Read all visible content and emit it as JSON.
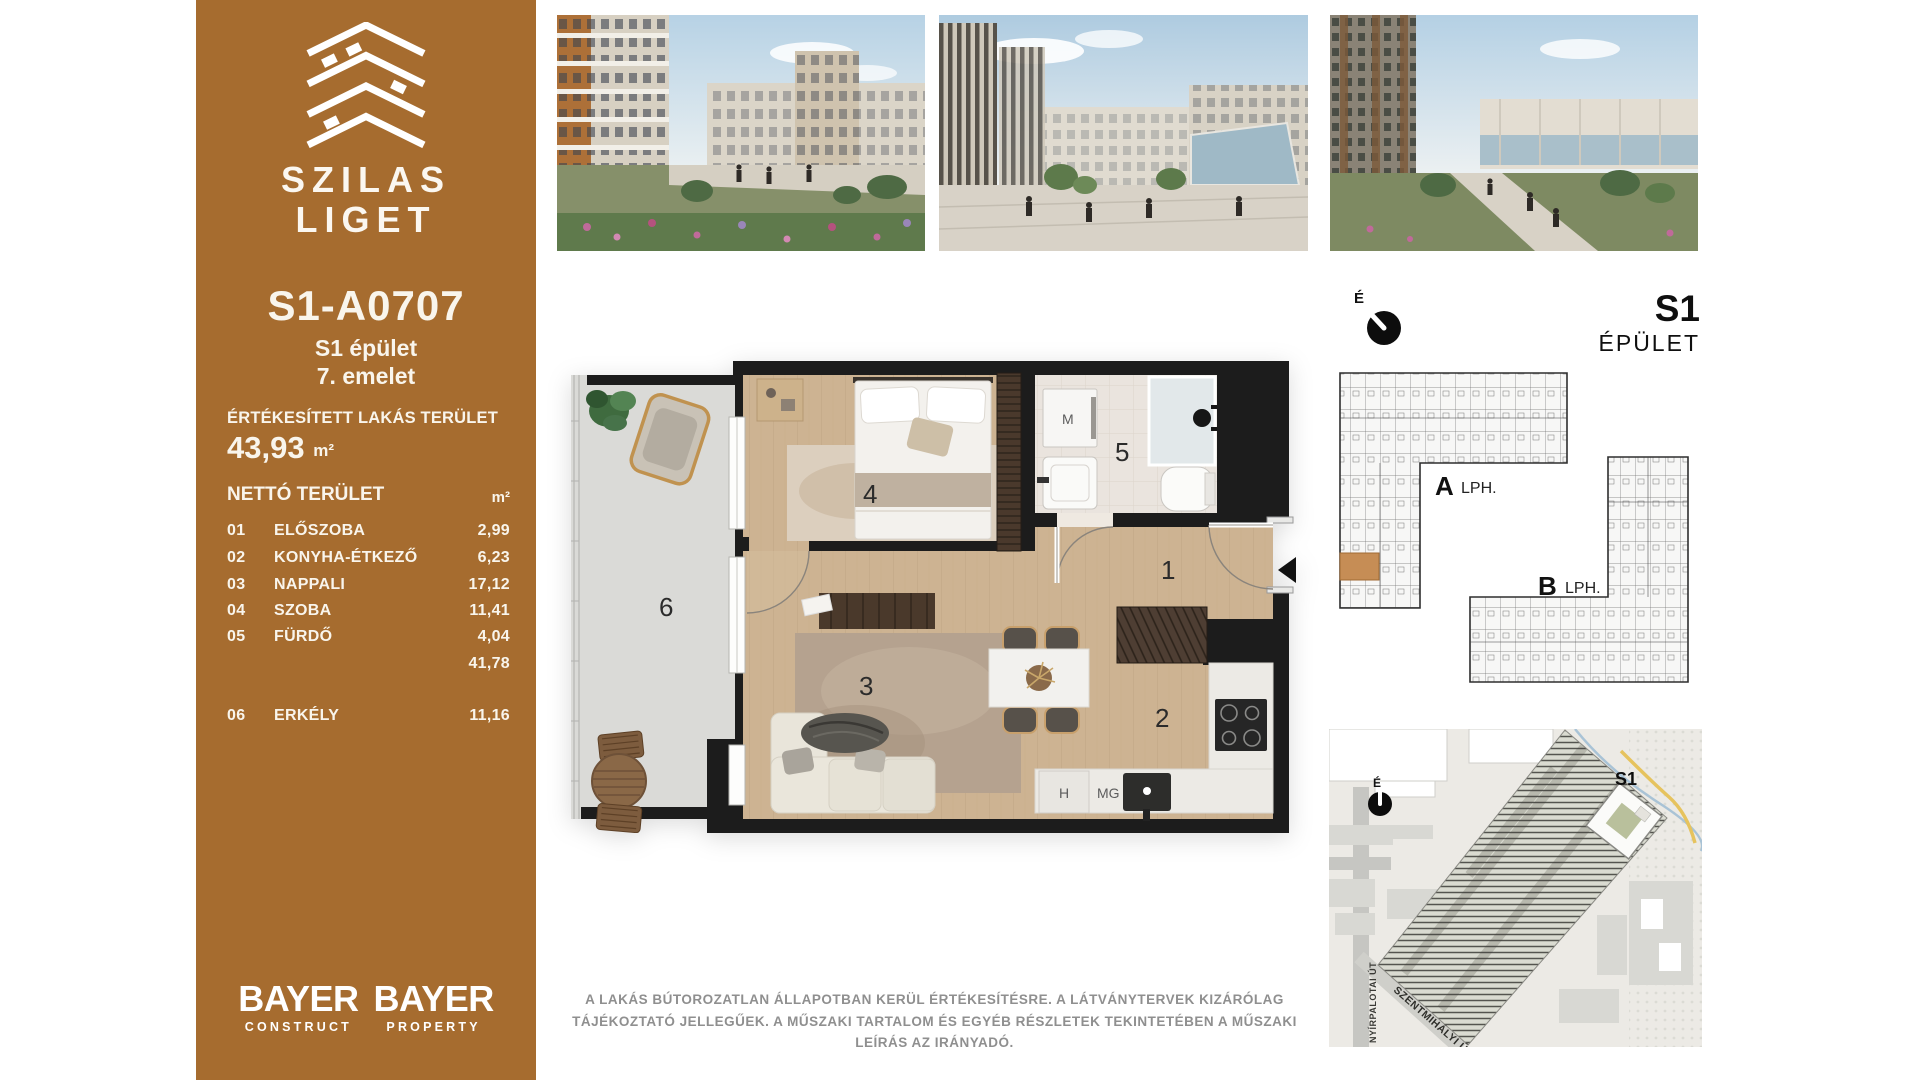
{
  "sidebar": {
    "brand": {
      "line1": "SZILAS",
      "line2": "LIGET"
    },
    "unit_id": "S1-A0707",
    "building": "S1 épület",
    "floor": "7. emelet",
    "sold_area_label": "ÉRTÉKESÍTETT LAKÁS TERÜLET",
    "sold_area_value": "43,93",
    "sold_area_unit": "m²",
    "net_area_label": "NETTÓ TERÜLET",
    "net_area_unit": "m²",
    "rooms": [
      {
        "num": "01",
        "name": "ELŐSZOBA",
        "area": "2,99"
      },
      {
        "num": "02",
        "name": "KONYHA-ÉTKEZŐ",
        "area": "6,23"
      },
      {
        "num": "03",
        "name": "NAPPALI",
        "area": "17,12"
      },
      {
        "num": "04",
        "name": "SZOBA",
        "area": "11,41"
      },
      {
        "num": "05",
        "name": "FÜRDŐ",
        "area": "4,04"
      }
    ],
    "net_subtotal": "41,78",
    "balcony_row": {
      "num": "06",
      "name": "ERKÉLY",
      "area": "11,16"
    },
    "logos": [
      {
        "brand": "BAYER",
        "sub": "CONSTRUCT"
      },
      {
        "brand": "BAYER",
        "sub": "PROPERTY"
      }
    ]
  },
  "floorplan": {
    "numbers": {
      "hall": "1",
      "kitchen": "2",
      "living": "3",
      "bedroom": "4",
      "bathroom": "5",
      "balcony": "6"
    },
    "labels": {
      "m": "M",
      "h": "H",
      "mg": "MG"
    }
  },
  "building_key": {
    "north": "É",
    "code": "S1",
    "word": "ÉPÜLET",
    "wing_a": "A",
    "wing_a_sub": "LPH.",
    "wing_b": "B",
    "wing_b_sub": "LPH."
  },
  "site_map": {
    "north": "É",
    "building": "S1",
    "street_vertical": "NYÍRPALOTAI ÚT",
    "street_diagonal": "SZENTMIHÁLYI ÚT"
  },
  "disclaimer": {
    "text": "A LAKÁS BÚTOROZATLAN ÁLLAPOTBAN KERÜL ÉRTÉKESÍTÉSRE. A LÁTVÁNYTERVEK KIZÁRÓLAG TÁJÉKOZTATÓ JELLEGŰEK. A MŰSZAKI TARTALOM ÉS EGYÉB RÉSZLETEK TEKINTETÉBEN A MŰSZAKI LEÍRÁS AZ IRÁNYADÓ."
  },
  "colors": {
    "sidebar_brown": "#a66c2f",
    "highlight_unit": "#c68d55",
    "wall_black": "#1c1c1c",
    "wood_floor": "#cdb392",
    "balcony_concrete": "#dadad7"
  }
}
